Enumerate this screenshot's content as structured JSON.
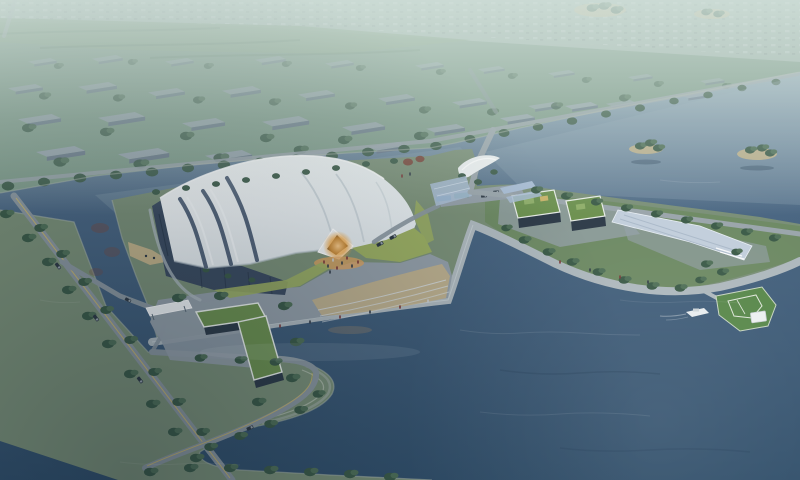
{
  "scene": {
    "label": "Aerial architectural rendering of a white shell-roofed exhibition hall on a lakeside site",
    "elements": [
      "hazy-distant-town",
      "farmland-band",
      "city-blocks",
      "shore-road-with-trees",
      "lake",
      "tree-islands",
      "exhibition-hall",
      "hall-entrance-glow",
      "waterfront-plaza",
      "promenade",
      "junction-plaza",
      "floating-solar-array",
      "green-roof-buildings",
      "solar-ramp",
      "sports-pier",
      "boat",
      "access-roads",
      "gate-canopy",
      "l-shaped-building"
    ]
  },
  "colors": {
    "haze": "#d3e2dc",
    "haze_band": "#9db1a8",
    "town_light": "#b9c8c3",
    "town_dark": "#879894",
    "field_green": "#7f9c82",
    "hedge_green": "#5f7f68",
    "city_ground": "#7d9a88",
    "slab_roof": "#98a5af",
    "slab_wall": "#68778a",
    "tree_dark": "#3c5b48",
    "tree_mid": "#507058",
    "red_tree": "#7a4a3e",
    "water_far": "#a3b8c2",
    "water_mid": "#4a6682",
    "water_deep": "#32506b",
    "shore_wall": "#aab4a9",
    "road": "#8a969e",
    "road_light": "#9aa5ab",
    "road_yellow": "#d2ba62",
    "promenade": "#aeb8bd",
    "plaza": "#939ea7",
    "plaza_light": "#95a0a8",
    "tan_paving": "#c2b088",
    "lawn": "#9aad62",
    "land_green": "#7a8f77",
    "peninsula_green": "#6e8a64",
    "roof_white": "#f6f8f8",
    "roof_shade": "#dfe6e9",
    "roof_seam": "#ccd5da",
    "shell_gap": "#55657a",
    "facade_dark": "#3c4c60",
    "facade_stripe": "#2b394b",
    "canopy_white": "#eef1f2",
    "entrance_dark": "#4a3a2e",
    "glow_orange": "#f0a43c",
    "glow_apron": "#dfa35e",
    "green_roof": "#6d9150",
    "building_wall": "#2f3c49",
    "panel_blue": "#a8bcd4",
    "ramp_light": "#c2cedb",
    "ramp_line": "#aab9c9",
    "field_court": "#59884b",
    "court_line": "#dfe7da",
    "pavilion_white": "#eceff0",
    "boat_white": "#e9edef",
    "bus_teal": "#3f7ba0",
    "bus_green": "#46897f",
    "car_dark": "#2f3a45",
    "car_glass": "#b9c4cc",
    "people_red": "#7c3a3a",
    "people_light": "#c9cdd1",
    "people_dark": "#333d49",
    "sand": "#c0b189"
  }
}
